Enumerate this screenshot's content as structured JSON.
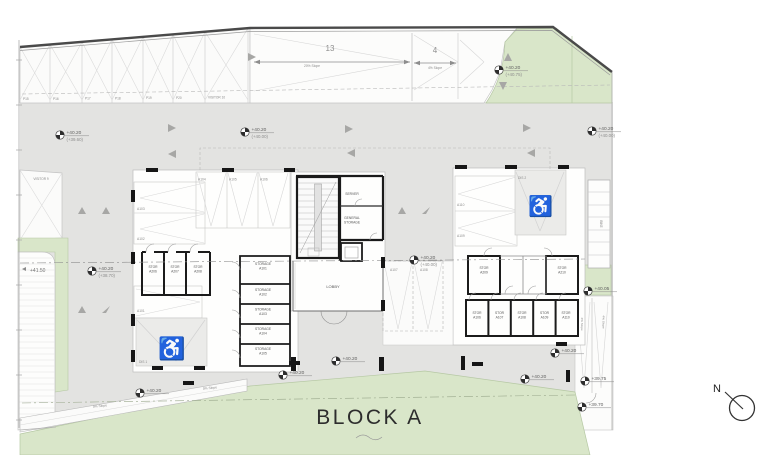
{
  "title": {
    "block": "BLOCK A"
  },
  "compass": {
    "label": "N"
  },
  "colors": {
    "green": "#d9e6c9",
    "gray": "#e3e3e1",
    "wall": "#1b1b1b",
    "thin": "#b5b5b5",
    "accentText": "#606060"
  },
  "plan": {
    "labels": [
      {
        "t": "P15",
        "x": 23,
        "y": 100,
        "s": 3.2
      },
      {
        "t": "P16",
        "x": 53,
        "y": 100,
        "s": 3.2
      },
      {
        "t": "P17",
        "x": 85,
        "y": 99.5,
        "s": 3.2
      },
      {
        "t": "P18",
        "x": 115,
        "y": 99.5,
        "s": 3.2
      },
      {
        "t": "P19",
        "x": 146,
        "y": 99,
        "s": 3.2
      },
      {
        "t": "P20",
        "x": 176,
        "y": 99,
        "s": 3.2
      },
      {
        "t": "VISITOR 10",
        "x": 208,
        "y": 98.5,
        "s": 3.2
      },
      {
        "t": "VISITOR 9",
        "x": 41,
        "y": 180,
        "s": 3.2,
        "a": "m"
      },
      {
        "t": "A104",
        "x": 198,
        "y": 180.5,
        "s": 3.3
      },
      {
        "t": "A105",
        "x": 229,
        "y": 180.5,
        "s": 3.3
      },
      {
        "t": "A106",
        "x": 260,
        "y": 180.5,
        "s": 3.3
      },
      {
        "t": "A103",
        "x": 137,
        "y": 210,
        "s": 3.3
      },
      {
        "t": "A102",
        "x": 137,
        "y": 240,
        "s": 3.3
      },
      {
        "t": "A101",
        "x": 137,
        "y": 312,
        "s": 3.3
      },
      {
        "t": "DIS 1",
        "x": 139,
        "y": 363,
        "s": 3.3
      },
      {
        "t": "A110",
        "x": 457,
        "y": 206,
        "s": 3.3
      },
      {
        "t": "A109",
        "x": 457,
        "y": 237,
        "s": 3.3
      },
      {
        "t": "DIS 2",
        "x": 518,
        "y": 179,
        "s": 3.3
      },
      {
        "t": "A107",
        "x": 390,
        "y": 271,
        "s": 3.3
      },
      {
        "t": "A108",
        "x": 420,
        "y": 271,
        "s": 3.3
      },
      {
        "t": [
          "STOR",
          "A206"
        ],
        "x": 153,
        "y": 268,
        "s": 3.3,
        "a": "m",
        "c": "#555555"
      },
      {
        "t": [
          "STOR",
          "A207"
        ],
        "x": 175,
        "y": 268,
        "s": 3.3,
        "a": "m",
        "c": "#555555"
      },
      {
        "t": [
          "STOR",
          "A208"
        ],
        "x": 198,
        "y": 268,
        "s": 3.3,
        "a": "m",
        "c": "#555555"
      },
      {
        "t": [
          "STORAGE",
          "A101"
        ],
        "x": 263,
        "y": 265,
        "s": 3.3,
        "a": "m",
        "c": "#555555"
      },
      {
        "t": [
          "STORAGE",
          "A102"
        ],
        "x": 263,
        "y": 291,
        "s": 3.3,
        "a": "m",
        "c": "#555555"
      },
      {
        "t": [
          "STORAGE",
          "A103"
        ],
        "x": 263,
        "y": 310.5,
        "s": 3.3,
        "a": "m",
        "c": "#555555"
      },
      {
        "t": [
          "STORAGE",
          "A104"
        ],
        "x": 263,
        "y": 330,
        "s": 3.3,
        "a": "m",
        "c": "#555555"
      },
      {
        "t": [
          "STORAGE",
          "A105"
        ],
        "x": 263,
        "y": 350,
        "s": 3.3,
        "a": "m",
        "c": "#555555"
      },
      {
        "t": "SERVER",
        "x": 352,
        "y": 195,
        "s": 3.3,
        "a": "m",
        "c": "#555555"
      },
      {
        "t": [
          "GENERAL",
          "STORAGE"
        ],
        "x": 352,
        "y": 219,
        "s": 3.3,
        "a": "m",
        "c": "#555555"
      },
      {
        "t": "LOBBY",
        "x": 333,
        "y": 288,
        "s": 4,
        "a": "m",
        "c": "#555555"
      },
      {
        "t": [
          "STOR",
          "A209"
        ],
        "x": 484,
        "y": 269,
        "s": 3.3,
        "a": "m",
        "c": "#555555"
      },
      {
        "t": [
          "STOR",
          "A210"
        ],
        "x": 562,
        "y": 269,
        "s": 3.3,
        "a": "m",
        "c": "#555555"
      },
      {
        "t": [
          "STOR",
          "A106"
        ],
        "x": 477,
        "y": 314,
        "s": 3.3,
        "a": "m",
        "c": "#555555"
      },
      {
        "t": [
          "STOR",
          "A107"
        ],
        "x": 499.5,
        "y": 314,
        "s": 3.3,
        "a": "m",
        "c": "#555555"
      },
      {
        "t": [
          "STOR",
          "A108"
        ],
        "x": 522,
        "y": 314,
        "s": 3.3,
        "a": "m",
        "c": "#555555"
      },
      {
        "t": [
          "STOR",
          "A109"
        ],
        "x": 544.5,
        "y": 314,
        "s": 3.3,
        "a": "m",
        "c": "#555555"
      },
      {
        "t": [
          "STOR",
          "A110"
        ],
        "x": 566,
        "y": 314,
        "s": 3.3,
        "a": "m",
        "c": "#555555"
      },
      {
        "t": "BIKE",
        "x": 600,
        "y": 224,
        "s": 3.2,
        "a": "m",
        "r": 90
      },
      {
        "t": "13",
        "x": 330,
        "y": 51,
        "s": 8,
        "a": "m",
        "c": "#8f8f8f"
      },
      {
        "t": "4",
        "x": 435,
        "y": 53,
        "s": 8,
        "a": "m",
        "c": "#8f8f8f"
      },
      {
        "t": "20% Slope",
        "x": 312,
        "y": 67,
        "s": 3.3,
        "a": "m"
      },
      {
        "t": "4% Slope",
        "x": 435,
        "y": 69,
        "s": 3.3,
        "a": "m"
      },
      {
        "t": "5% Slope",
        "x": 100,
        "y": 407,
        "s": 3.3,
        "a": "m",
        "r": -5
      },
      {
        "t": "5% Slope",
        "x": 210,
        "y": 389,
        "s": 3.3,
        "a": "m",
        "r": -5
      },
      {
        "t": "4% Slope",
        "x": 581,
        "y": 324,
        "s": 3.1,
        "a": "m",
        "r": 90
      },
      {
        "t": "4% Slope",
        "x": 602.5,
        "y": 322,
        "s": 3.1,
        "a": "m",
        "r": 90
      },
      {
        "t": "+41.50",
        "x": 30,
        "y": 272,
        "s": 5,
        "c": "#757575"
      }
    ],
    "markers": [
      {
        "x": 60,
        "y": 135,
        "v": "+40.20",
        "v2": "(+39.60)"
      },
      {
        "x": 245,
        "y": 132,
        "v": "+40.20",
        "v2": "(+40.00)"
      },
      {
        "x": 499,
        "y": 70,
        "v": "+40.20",
        "v2": "(+40.75)"
      },
      {
        "x": 592,
        "y": 131,
        "v": "+40.20",
        "v2": "(+40.00)"
      },
      {
        "x": 92,
        "y": 271,
        "v": "+40.20",
        "v2": "(+38.70)"
      },
      {
        "x": 414,
        "y": 260,
        "v": "+40.20",
        "v2": "(+40.00)"
      },
      {
        "x": 588,
        "y": 291,
        "v": "+40.05"
      },
      {
        "x": 555,
        "y": 353,
        "v": "+40.20"
      },
      {
        "x": 525,
        "y": 379,
        "v": "+40.20"
      },
      {
        "x": 585,
        "y": 381,
        "v": "+39.75"
      },
      {
        "x": 582,
        "y": 407,
        "v": "+39.70"
      },
      {
        "x": 140,
        "y": 393,
        "v": "+40.20"
      },
      {
        "x": 283,
        "y": 375,
        "v": "+40.20"
      },
      {
        "x": 336,
        "y": 361,
        "v": "+40.20"
      }
    ]
  }
}
